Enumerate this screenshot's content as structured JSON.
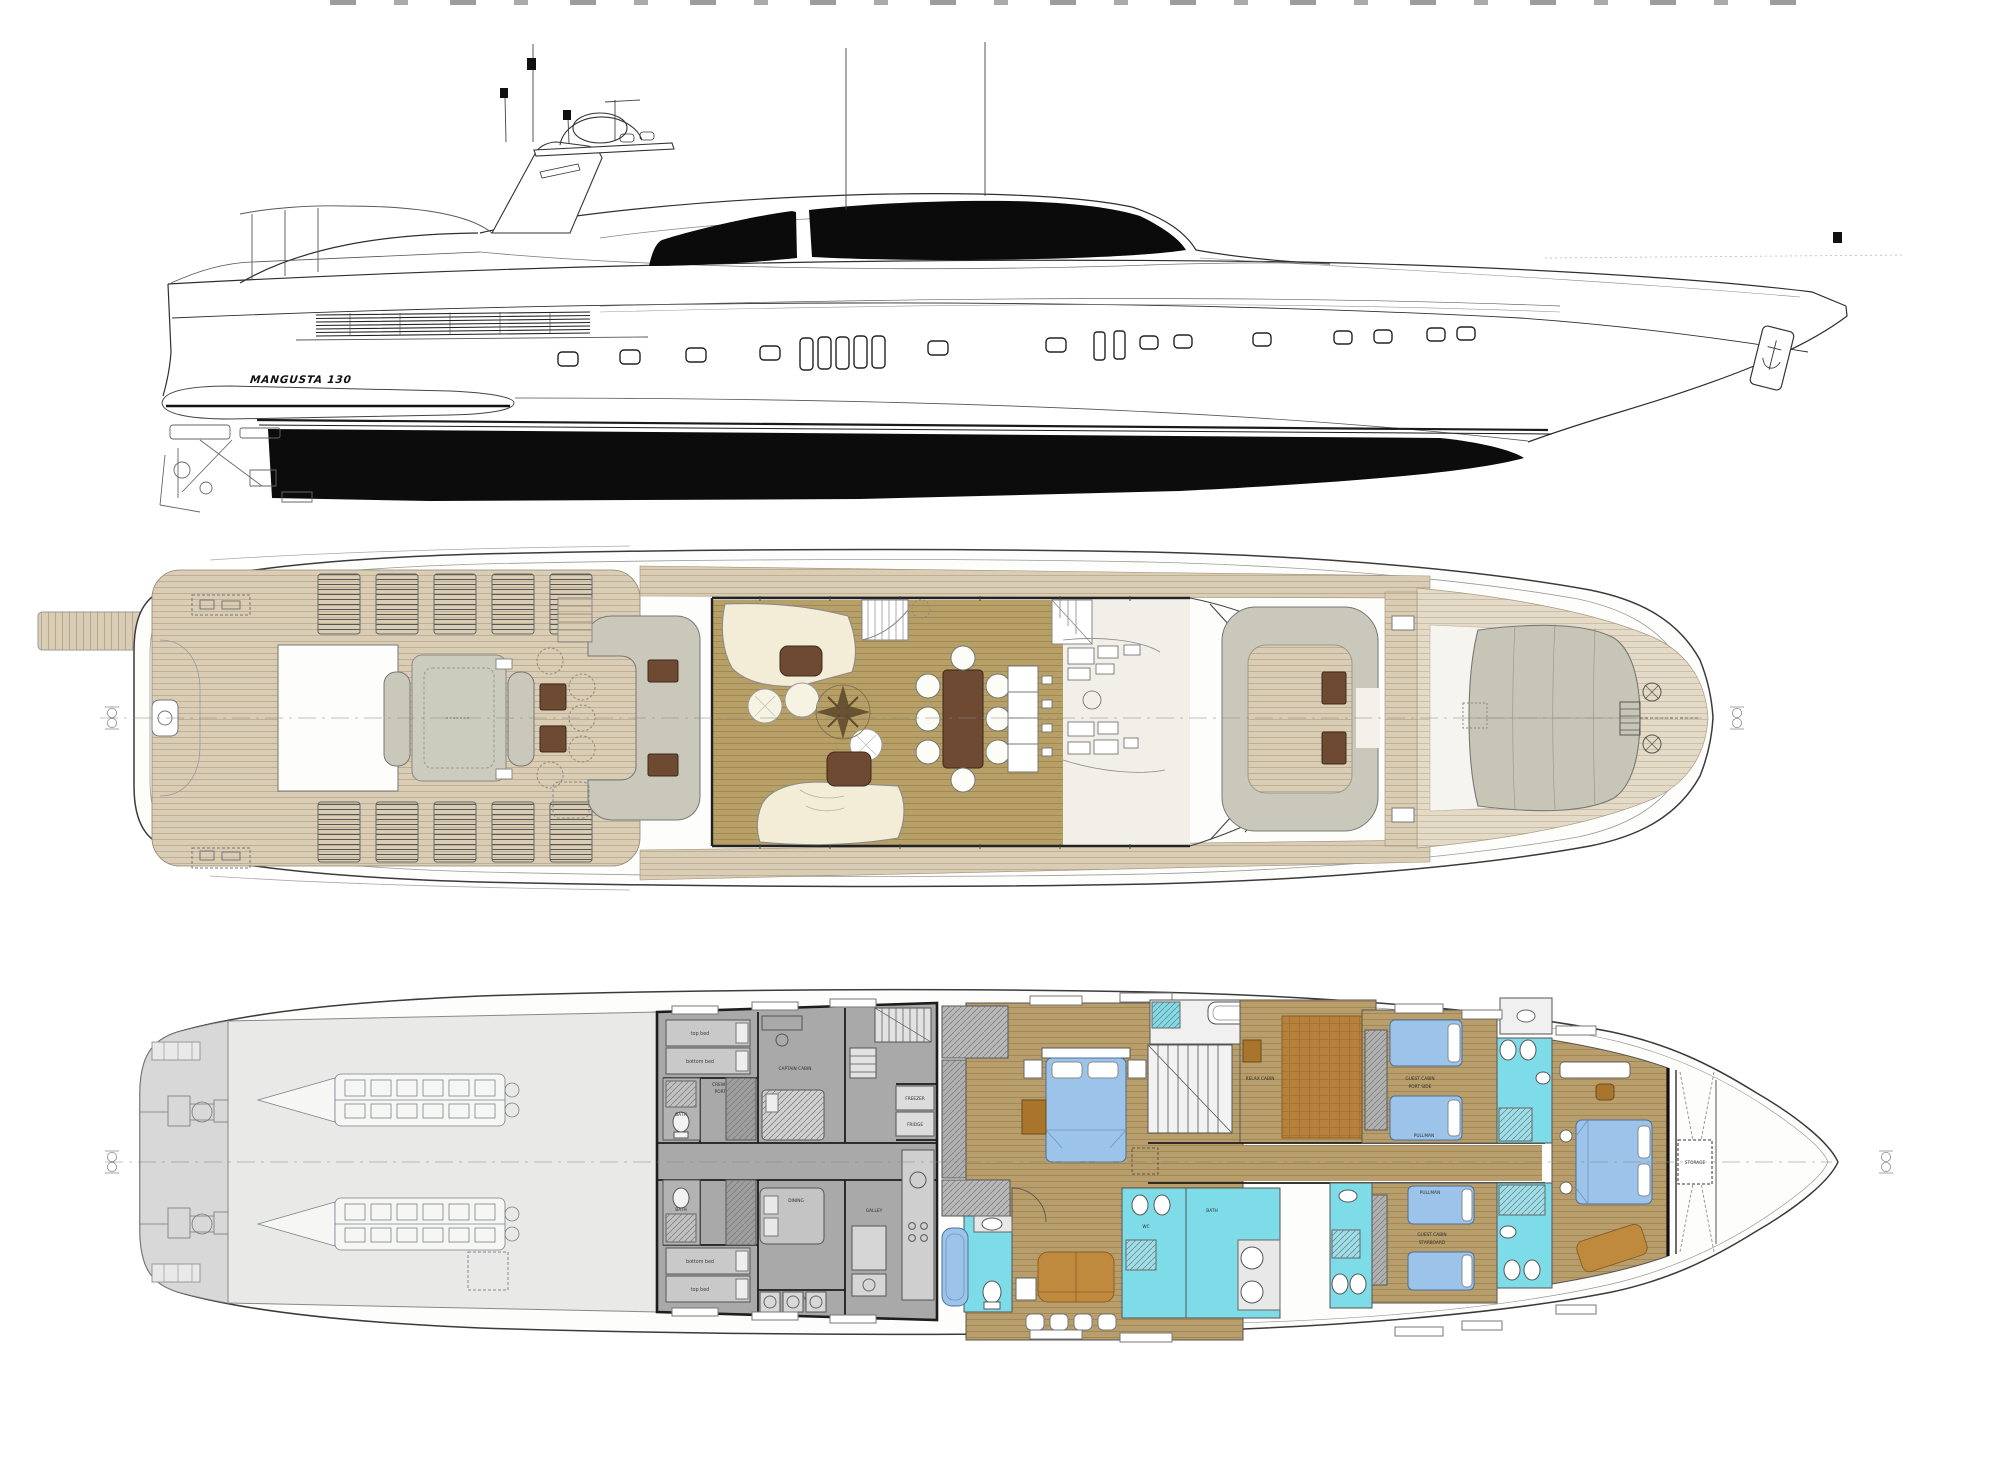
{
  "document": {
    "kind": "yacht general arrangement drawing",
    "views": [
      "side profile",
      "main deck plan",
      "lower deck plan"
    ]
  },
  "profile": {
    "name_plate": "MANGUSTA 130"
  },
  "lower_deck_labels": {
    "top_bed": "top bed",
    "bottom_bed": "bottom bed",
    "crew_cabin_line1": "CREW CABIN",
    "crew_cabin_line2": "PORT SIDE",
    "captain_cabin": "CAPTAIN CABIN",
    "bath": "BATH",
    "wc": "WC",
    "dining": "DINING",
    "laundry": "LAUNDRY",
    "galley": "GALLEY",
    "freezer": "FREEZER",
    "fridge": "FRIDGE",
    "relax_cabin": "RELAX CABIN",
    "guest_cabin": "GUEST CABIN",
    "port_side": "PORT SIDE",
    "starboard": "STARBOARD",
    "pullman": "PULLMAN",
    "storage": "STORAGE"
  },
  "colors": {
    "teak_deck": "#d9cdb6",
    "teak_pale": "#e4dac8",
    "salon_wood": "#b7a068",
    "cabin_wood": "#b89e6c",
    "bed_blue": "#9cc4ea",
    "bath_cyan": "#7edbe8",
    "upholstery_gray": "#c9c8ba",
    "cream_sofa": "#f3edd7",
    "table_brown": "#6e4a33",
    "accent_brown": "#c08a3e",
    "tatami_brown": "#b5813c",
    "crew_gray": "#a9a9a9",
    "engine_room_gray": "#e9e9e7",
    "hull_black": "#0c0c0c"
  }
}
